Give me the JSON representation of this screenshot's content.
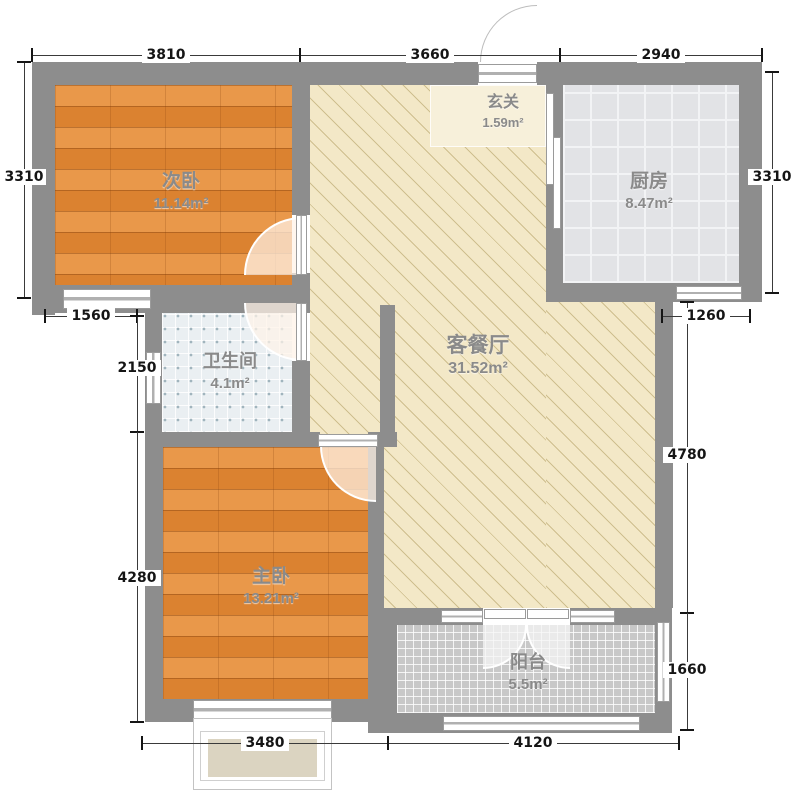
{
  "rooms": [
    {
      "name": "次卧",
      "area": "11.14m²"
    },
    {
      "name": "玄关",
      "area": "1.59m²"
    },
    {
      "name": "厨房",
      "area": "8.47m²"
    },
    {
      "name": "卫生间",
      "area": "4.1m²"
    },
    {
      "name": "客餐厅",
      "area": "31.52m²"
    },
    {
      "name": "主卧",
      "area": "13.21m²"
    },
    {
      "name": "阳台",
      "area": "5.5m²"
    }
  ],
  "dims": {
    "top": [
      "3810",
      "3660",
      "2940"
    ],
    "left": [
      "3310",
      "1560",
      "2150",
      "4280"
    ],
    "right": [
      "3310",
      "1260",
      "4780",
      "1660"
    ],
    "bottom": [
      "3480",
      "4120"
    ]
  },
  "colors": {
    "wall": "#8d8d8d",
    "wood_floor": "#e08c39",
    "living_floor": "#f3e8c7",
    "kitchen_floor": "#e2e3e6",
    "bath_floor": "#eaeff2",
    "balcony_floor": "#c8c8c8",
    "entry_highlight": "#f7f0da",
    "dim_text": "#151515",
    "room_label": "#8a8a8a"
  }
}
